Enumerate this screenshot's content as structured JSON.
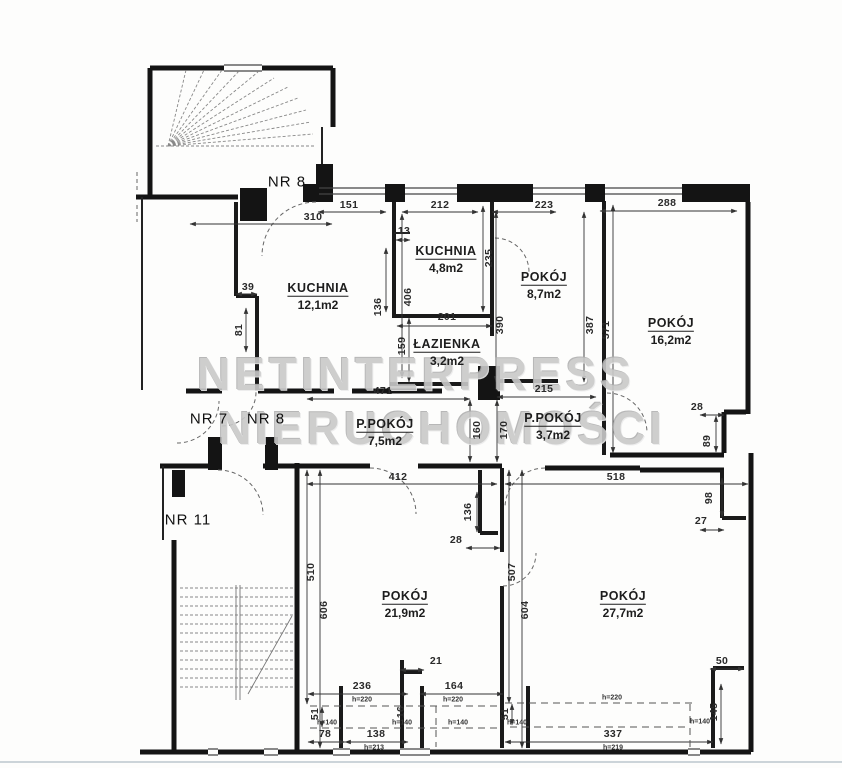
{
  "meta": {
    "width": 842,
    "height": 768,
    "drawing_type": "apartment floor plan"
  },
  "colors": {
    "ink": "#141414",
    "dim_line": "#333333",
    "stair": "#888888",
    "arc": "#666666",
    "watermark": "#c9c9c9",
    "scanline": "#ccd4d9"
  },
  "watermark": {
    "line1": "NETINTERPRESS",
    "line2": "NIERUCHOMOŚCI",
    "pos1": {
      "x": 416,
      "y": 374
    },
    "pos2": {
      "x": 442,
      "y": 428
    }
  },
  "units": [
    {
      "label": "NR 8",
      "x": 287,
      "y": 182
    },
    {
      "label": "NR 7",
      "x": 209,
      "y": 419
    },
    {
      "label": "NR 8",
      "x": 266,
      "y": 419
    },
    {
      "label": "NR 11",
      "x": 188,
      "y": 520
    }
  ],
  "rooms": [
    {
      "name": "KUCHNIA",
      "area": "12,1m2",
      "x": 318,
      "y": 295
    },
    {
      "name": "KUCHNIA",
      "area": "4,8m2",
      "x": 446,
      "y": 258
    },
    {
      "name": "POKÓJ",
      "area": "8,7m2",
      "x": 544,
      "y": 284
    },
    {
      "name": "POKÓJ",
      "area": "16,2m2",
      "x": 671,
      "y": 330
    },
    {
      "name": "ŁAZIENKA",
      "area": "3,2m2",
      "x": 447,
      "y": 351
    },
    {
      "name": "P.POKÓJ",
      "area": "7,5m2",
      "x": 385,
      "y": 431
    },
    {
      "name": "P.POKÓJ",
      "area": "3,7m2",
      "x": 553,
      "y": 425
    },
    {
      "name": "POKÓJ",
      "area": "21,9m2",
      "x": 405,
      "y": 603
    },
    {
      "name": "POKÓJ",
      "area": "27,7m2",
      "x": 623,
      "y": 603
    }
  ],
  "dimensions": [
    {
      "t": "310",
      "x": 313,
      "y": 217,
      "r": 0,
      "line": [
        190,
        224,
        332,
        224
      ]
    },
    {
      "t": "151",
      "x": 349,
      "y": 205,
      "r": 0,
      "line": [
        318,
        212,
        386,
        212
      ]
    },
    {
      "t": "212",
      "x": 440,
      "y": 205,
      "r": 0,
      "line": [
        402,
        212,
        478,
        212
      ]
    },
    {
      "t": "223",
      "x": 544,
      "y": 205,
      "r": 0,
      "line": [
        492,
        212,
        556,
        212
      ]
    },
    {
      "t": "288",
      "x": 667,
      "y": 203,
      "r": 0,
      "line": [
        600,
        211,
        737,
        211
      ]
    },
    {
      "t": "13",
      "x": 404,
      "y": 231,
      "r": 0,
      "line": [
        396,
        240,
        410,
        240
      ]
    },
    {
      "t": "39",
      "x": 248,
      "y": 287,
      "r": 0,
      "line": [
        236,
        294,
        257,
        294
      ]
    },
    {
      "t": "81",
      "x": 239,
      "y": 330,
      "r": 90,
      "line": [
        246,
        308,
        246,
        352
      ]
    },
    {
      "t": "406",
      "x": 408,
      "y": 297,
      "r": 90,
      "line": [
        402,
        214,
        402,
        378
      ]
    },
    {
      "t": "136",
      "x": 378,
      "y": 307,
      "r": 90,
      "line": [
        386,
        248,
        386,
        312
      ]
    },
    {
      "t": "235",
      "x": 489,
      "y": 258,
      "r": 90,
      "line": [
        483,
        206,
        483,
        312
      ]
    },
    {
      "t": "390",
      "x": 500,
      "y": 325,
      "r": 90,
      "line": [
        496,
        212,
        496,
        382
      ]
    },
    {
      "t": "387",
      "x": 590,
      "y": 325,
      "r": 90,
      "line": [
        584,
        212,
        584,
        382
      ]
    },
    {
      "t": "571",
      "x": 606,
      "y": 330,
      "r": 90,
      "line": [
        613,
        205,
        613,
        453
      ]
    },
    {
      "t": "201",
      "x": 447,
      "y": 317,
      "r": 0,
      "line": [
        397,
        326,
        492,
        326
      ]
    },
    {
      "t": "159",
      "x": 402,
      "y": 346,
      "r": 90,
      "line": [
        409,
        318,
        409,
        382
      ]
    },
    {
      "t": "471",
      "x": 383,
      "y": 391,
      "r": 0,
      "line": [
        307,
        399,
        470,
        399
      ]
    },
    {
      "t": "215",
      "x": 544,
      "y": 389,
      "r": 0,
      "line": [
        497,
        397,
        596,
        397
      ]
    },
    {
      "t": "160",
      "x": 477,
      "y": 430,
      "r": 90,
      "line": [
        470,
        400,
        470,
        462
      ]
    },
    {
      "t": "170",
      "x": 504,
      "y": 430,
      "r": 90,
      "line": [
        497,
        400,
        497,
        462
      ]
    },
    {
      "t": "28",
      "x": 697,
      "y": 407,
      "r": 0,
      "line": [
        700,
        415,
        724,
        415
      ]
    },
    {
      "t": "89",
      "x": 707,
      "y": 441,
      "r": 90,
      "line": [
        716,
        416,
        716,
        452
      ]
    },
    {
      "t": "412",
      "x": 398,
      "y": 477,
      "r": 0,
      "line": [
        307,
        484,
        497,
        484
      ]
    },
    {
      "t": "518",
      "x": 616,
      "y": 477,
      "r": 0,
      "line": [
        505,
        484,
        748,
        484
      ]
    },
    {
      "t": "136",
      "x": 468,
      "y": 512,
      "r": 90,
      "line": [
        477,
        492,
        477,
        532
      ]
    },
    {
      "t": "28",
      "x": 456,
      "y": 540,
      "r": 0,
      "line": [
        466,
        548,
        500,
        548
      ]
    },
    {
      "t": "98",
      "x": 709,
      "y": 498,
      "r": 90,
      "line": [
        722,
        478,
        722,
        517
      ]
    },
    {
      "t": "27",
      "x": 701,
      "y": 521,
      "r": 0,
      "line": [
        700,
        530,
        724,
        530
      ]
    },
    {
      "t": "510",
      "x": 311,
      "y": 572,
      "r": 90,
      "line": [
        307,
        470,
        307,
        704
      ]
    },
    {
      "t": "606",
      "x": 324,
      "y": 610,
      "r": 90,
      "line": [
        320,
        470,
        320,
        748
      ]
    },
    {
      "t": "507",
      "x": 512,
      "y": 572,
      "r": 90,
      "line": [
        509,
        470,
        509,
        703
      ]
    },
    {
      "t": "604",
      "x": 525,
      "y": 610,
      "r": 90,
      "line": [
        522,
        470,
        522,
        748
      ]
    },
    {
      "t": "21",
      "x": 436,
      "y": 661,
      "r": 0,
      "line": [
        400,
        670,
        424,
        670
      ]
    },
    {
      "t": "236",
      "x": 362,
      "y": 686,
      "r": 0,
      "line": [
        308,
        694,
        408,
        694
      ]
    },
    {
      "t": "164",
      "x": 454,
      "y": 686,
      "r": 0,
      "line": [
        420,
        694,
        503,
        694
      ]
    },
    {
      "t": "50",
      "x": 722,
      "y": 661,
      "r": 0,
      "line": [
        710,
        669,
        744,
        669
      ]
    },
    {
      "t": "145",
      "x": 714,
      "y": 712,
      "r": 90,
      "line": [
        721,
        684,
        721,
        744
      ]
    },
    {
      "t": "51",
      "x": 315,
      "y": 714,
      "r": 90,
      "line": [
        322,
        707,
        322,
        727
      ]
    },
    {
      "t": "51",
      "x": 505,
      "y": 714,
      "r": 90,
      "line": [
        512,
        704,
        512,
        725
      ]
    },
    {
      "t": "16",
      "x": 401,
      "y": 712,
      "r": 90
    },
    {
      "t": "78",
      "x": 325,
      "y": 734,
      "r": 0,
      "line": [
        308,
        742,
        345,
        742
      ]
    },
    {
      "t": "138",
      "x": 376,
      "y": 734,
      "r": 0,
      "line": [
        345,
        742,
        408,
        742
      ]
    },
    {
      "t": "337",
      "x": 613,
      "y": 734,
      "r": 0,
      "line": [
        505,
        742,
        713,
        742
      ]
    },
    {
      "t": "h=220",
      "x": 362,
      "y": 700,
      "r": 0,
      "small": true
    },
    {
      "t": "h=220",
      "x": 453,
      "y": 700,
      "r": 0,
      "small": true
    },
    {
      "t": "h=220",
      "x": 612,
      "y": 698,
      "r": 0,
      "small": true
    },
    {
      "t": "h=140",
      "x": 327,
      "y": 723,
      "r": 0,
      "small": true
    },
    {
      "t": "h=140",
      "x": 402,
      "y": 723,
      "r": 0,
      "small": true
    },
    {
      "t": "h=140",
      "x": 458,
      "y": 723,
      "r": 0,
      "small": true
    },
    {
      "t": "h=140",
      "x": 517,
      "y": 723,
      "r": 0,
      "small": true
    },
    {
      "t": "h=140",
      "x": 700,
      "y": 722,
      "r": 0,
      "small": true
    },
    {
      "t": "h=213",
      "x": 374,
      "y": 748,
      "r": 0,
      "small": true
    },
    {
      "t": "h=219",
      "x": 613,
      "y": 748,
      "r": 0,
      "small": true
    }
  ],
  "guides": [
    [
      310,
      706,
      497,
      706
    ],
    [
      505,
      703,
      695,
      703
    ],
    [
      310,
      728,
      497,
      728
    ],
    [
      510,
      727,
      688,
      727
    ],
    [
      690,
      704,
      690,
      748
    ],
    [
      436,
      706,
      436,
      747
    ]
  ]
}
